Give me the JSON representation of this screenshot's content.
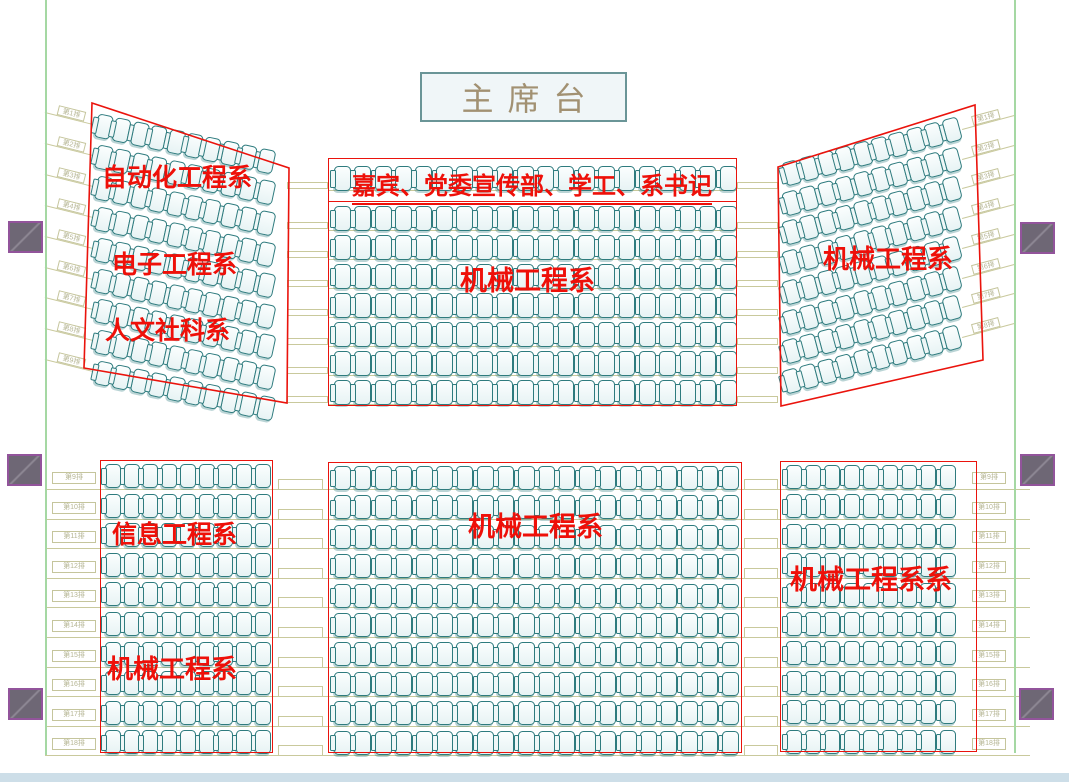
{
  "title": "礼堂座位安排图",
  "stage": {
    "label": "主席台",
    "x": 420,
    "y": 72,
    "w": 207,
    "h": 50,
    "font_size": 32,
    "text_color": "#a29172"
  },
  "colors": {
    "outline_red": "#ea130c",
    "label_red": "#ee1009",
    "seat_teal": "#2e7b7e",
    "guide_olive": "#c9c99c",
    "boundary_green": "#a5d8a3",
    "pillar_purple": "#92549b",
    "bottom_strip": "#cddee8",
    "stage_text": "#a29172"
  },
  "sections": [
    {
      "id": "upper-left-wing",
      "type": "wing",
      "quad": "92,103 289,168 287,403 84,368",
      "rows": 9,
      "cols": 10,
      "start_x": 96,
      "start_y": 113,
      "row_pitch": 30.9,
      "rot": 12,
      "col_pitch": 18.4,
      "seat_w": 16,
      "seat_h": 24,
      "labels": [
        {
          "text": "自动化工程系",
          "x": 102,
          "y": 165,
          "size": 25
        },
        {
          "text": "电子工程系",
          "x": 112,
          "y": 252,
          "size": 25
        },
        {
          "text": "人文社科系",
          "x": 105,
          "y": 318,
          "size": 25
        }
      ]
    },
    {
      "id": "guest-row",
      "type": "rect",
      "x": 328,
      "y": 158,
      "w": 409,
      "h": 44,
      "rows": 1,
      "cols": 20,
      "start_x": 334,
      "start_y": 166,
      "row_pitch": 29,
      "col_pitch": 20.3,
      "seat_w": 17,
      "seat_h": 25,
      "labels": [
        {
          "text": "嘉宾、党委宣传部、学工、系书记",
          "x": 352,
          "y": 174,
          "size": 24,
          "underline": true
        }
      ]
    },
    {
      "id": "upper-center",
      "type": "rect",
      "x": 328,
      "y": 201,
      "w": 409,
      "h": 205,
      "rows": 7,
      "cols": 20,
      "start_x": 334,
      "start_y": 206,
      "row_pitch": 29,
      "col_pitch": 20.3,
      "seat_w": 17,
      "seat_h": 25,
      "labels": [
        {
          "text": "机械工程系",
          "x": 460,
          "y": 266,
          "size": 27
        }
      ]
    },
    {
      "id": "upper-right-wing",
      "type": "wing",
      "quad": "778,167 975,105 983,360 781,406",
      "rows": 8,
      "cols": 10,
      "start_x": 784,
      "start_y": 163,
      "row_pitch": 29.7,
      "rot": -15,
      "col_pitch": 18.4,
      "seat_w": 16,
      "seat_h": 24,
      "labels": [
        {
          "text": "机械工程系",
          "x": 823,
          "y": 245,
          "size": 26
        }
      ]
    },
    {
      "id": "lower-left",
      "type": "rect",
      "x": 100,
      "y": 460,
      "w": 173,
      "h": 293,
      "rows": 10,
      "cols": 9,
      "start_x": 105,
      "start_y": 464,
      "row_pitch": 29.6,
      "col_pitch": 18.7,
      "seat_w": 16,
      "seat_h": 24,
      "labels": [
        {
          "text": "信息工程系",
          "x": 112,
          "y": 522,
          "size": 25
        },
        {
          "text": "机械工程系",
          "x": 107,
          "y": 655,
          "size": 26
        }
      ]
    },
    {
      "id": "lower-center",
      "type": "rect",
      "x": 328,
      "y": 462,
      "w": 414,
      "h": 291,
      "rows": 10,
      "cols": 20,
      "start_x": 334,
      "start_y": 466,
      "row_pitch": 29.4,
      "col_pitch": 20.4,
      "seat_w": 17,
      "seat_h": 24,
      "labels": [
        {
          "text": "机械工程系",
          "x": 468,
          "y": 512,
          "size": 27
        }
      ]
    },
    {
      "id": "lower-right",
      "type": "rect",
      "x": 780,
      "y": 461,
      "w": 197,
      "h": 291,
      "rows": 10,
      "cols": 9,
      "start_x": 786,
      "start_y": 465,
      "row_pitch": 29.4,
      "col_pitch": 19.2,
      "seat_w": 16,
      "seat_h": 24,
      "labels": [
        {
          "text": "机械工程系系",
          "x": 790,
          "y": 565,
          "size": 27
        }
      ]
    }
  ],
  "decor": {
    "green_lines": [
      {
        "x": 45,
        "h": 755
      },
      {
        "x": 1014,
        "h": 753
      }
    ],
    "pillars": [
      {
        "x": 8,
        "y": 221
      },
      {
        "x": 7,
        "y": 454
      },
      {
        "x": 8,
        "y": 688
      },
      {
        "x": 1020,
        "y": 222
      },
      {
        "x": 1020,
        "y": 454
      },
      {
        "x": 1019,
        "y": 688
      }
    ],
    "bottom_strip": {
      "y": 773,
      "h": 9
    },
    "lower_row_lines": {
      "x": 45,
      "w": 985,
      "y0": 489,
      "pitch": 29.6,
      "count": 10
    },
    "upper_row_lines": {
      "x": 328,
      "w": 409,
      "ys": [
        190,
        230,
        259,
        288,
        317,
        346,
        375,
        404
      ]
    },
    "upper_steps": {
      "xs": [
        287,
        737
      ],
      "w": 41,
      "h": 7,
      "ys": [
        182,
        222,
        251,
        280,
        309,
        338,
        367,
        396
      ]
    },
    "lower_steps": [
      {
        "x": 278,
        "w": 45,
        "h": 11,
        "y0": 479,
        "pitch": 29.6,
        "count": 10
      },
      {
        "x": 744,
        "w": 34,
        "h": 11,
        "y0": 479,
        "pitch": 29.6,
        "count": 10
      }
    ],
    "lower_tags_left": {
      "x": 52,
      "w": 44,
      "h": 12,
      "y0": 472,
      "pitch": 29.6,
      "labels": [
        "第9排",
        "第10排",
        "第11排",
        "第12排",
        "第13排",
        "第14排",
        "第15排",
        "第16排",
        "第17排",
        "第18排"
      ]
    },
    "lower_tags_right": {
      "x": 972,
      "w": 34,
      "h": 12,
      "y0": 472,
      "pitch": 29.6,
      "labels": [
        "第9排",
        "第10排",
        "第11排",
        "第12排",
        "第13排",
        "第14排",
        "第15排",
        "第16排",
        "第17排",
        "第18排"
      ]
    },
    "upper_ext_left": {
      "x": 45,
      "w": 53,
      "rot": 14,
      "y0": 125,
      "pitch": 30.9,
      "labels": [
        "第1排",
        "第2排",
        "第3排",
        "第4排",
        "第5排",
        "第6排",
        "第7排",
        "第8排",
        "第9排"
      ]
    },
    "upper_ext_right": {
      "x": 962,
      "w": 54,
      "rot": -15,
      "y0": 129,
      "pitch": 29.7,
      "labels": [
        "第1排",
        "第2排",
        "第3排",
        "第4排",
        "第5排",
        "第6排",
        "第7排",
        "第8排"
      ]
    }
  }
}
